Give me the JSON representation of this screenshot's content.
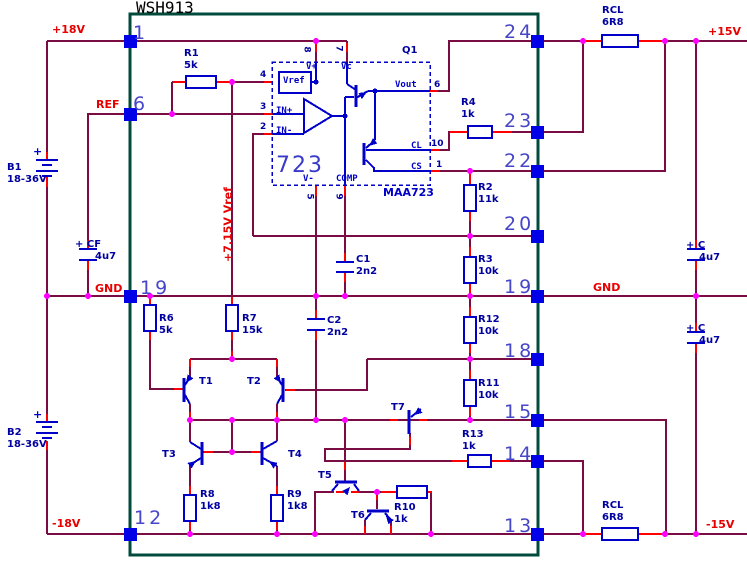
{
  "title": "WSH913",
  "nets": {
    "p18": "+18V",
    "ref": "REF",
    "gndL": "GND",
    "n18": "-18V",
    "p15": "+15V",
    "gndR": "GND",
    "n15": "-15V",
    "vrail": "+7.15V Vref"
  },
  "pins": {
    "p1": "1",
    "p6": "6",
    "p19L": "19",
    "p12": "12",
    "p24": "24",
    "p23": "23",
    "p22": "22",
    "p20": "20",
    "p19R": "19",
    "p18": "18",
    "p15": "15",
    "p14": "14",
    "p13": "13"
  },
  "ic": {
    "big": "723",
    "part": "MAA723",
    "q": "Q1",
    "vplus": "V+",
    "vc": "Vc",
    "vrefbox": "Vref",
    "inp": "IN+",
    "inn": "IN-",
    "vout": "Vout",
    "cl": "CL",
    "cs": "CS",
    "comp": "COMP",
    "vminus": "V-",
    "n4": "4",
    "n3": "3",
    "n2": "2",
    "n8": "8",
    "n7": "7",
    "n6": "6",
    "n10": "10",
    "n1": "1",
    "n5": "5",
    "n9": "9"
  },
  "parts": {
    "R1": {
      "r": "R1",
      "v": "5k"
    },
    "R2": {
      "r": "R2",
      "v": "11k"
    },
    "R3": {
      "r": "R3",
      "v": "10k"
    },
    "R4": {
      "r": "R4",
      "v": "1k"
    },
    "R6": {
      "r": "R6",
      "v": "5k"
    },
    "R7": {
      "r": "R7",
      "v": "15k"
    },
    "R8": {
      "r": "R8",
      "v": "1k8"
    },
    "R9": {
      "r": "R9",
      "v": "1k8"
    },
    "R10": {
      "r": "R10",
      "v": "1k"
    },
    "R11": {
      "r": "R11",
      "v": "10k"
    },
    "R12": {
      "r": "R12",
      "v": "10k"
    },
    "R13": {
      "r": "R13",
      "v": "1k"
    },
    "RCLt": {
      "r": "RCL",
      "v": "6R8"
    },
    "RCLb": {
      "r": "RCL",
      "v": "6R8"
    },
    "C1": {
      "r": "C1",
      "v": "2n2"
    },
    "C2": {
      "r": "C2",
      "v": "2n2"
    },
    "CF": {
      "r": "+ CF",
      "v": "4u7"
    },
    "Ct": {
      "r": "+ C",
      "v": "4u7"
    },
    "Cb": {
      "r": "+ C",
      "v": "4u7"
    },
    "B1": {
      "r": "B1",
      "v": "18-36V"
    },
    "B2": {
      "r": "B2",
      "v": "18-36V"
    },
    "T1": "T1",
    "T2": "T2",
    "T3": "T3",
    "T4": "T4",
    "T5": "T5",
    "T6": "T6",
    "T7": "T7"
  },
  "sym": {
    "plus": "+"
  },
  "colors": {
    "wire": "#7A0B43",
    "terminal": "#FF0000",
    "blue": "#0000C8",
    "dot": "#FF00FF",
    "square": "#0000E8",
    "border": "#004B3C",
    "net": "#E80000",
    "num": "#4646C8",
    "label": "#0000A0"
  }
}
